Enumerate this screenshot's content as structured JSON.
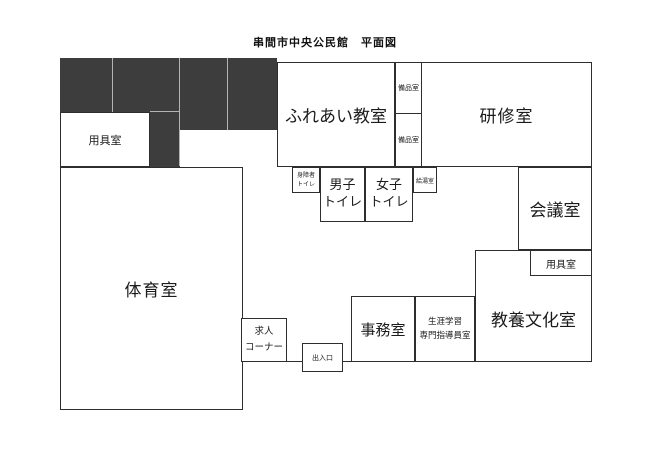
{
  "title": "串間市中央公民館　平面図",
  "rooms": {
    "equipment_upper_left": {
      "label": "用具室"
    },
    "gymnasium": {
      "label": "体育室"
    },
    "fureai_classroom": {
      "label": "ふれあい教室"
    },
    "supplies_upper": {
      "label": "備品室"
    },
    "supplies_lower": {
      "label": "備品室"
    },
    "training_room": {
      "label": "研修室"
    },
    "accessible_toilet": {
      "label": "身障者\nトイレ"
    },
    "mens_toilet": {
      "label": "男子\nトイレ"
    },
    "womens_toilet": {
      "label": "女子\nトイレ"
    },
    "hot_water_room": {
      "label": "給湯室"
    },
    "conference_room": {
      "label": "会議室"
    },
    "equipment_right": {
      "label": "用具室"
    },
    "culture_room": {
      "label": "教養文化室"
    },
    "office": {
      "label": "事務室"
    },
    "lifelong_learning_office": {
      "label": "生涯学習\n専門指導員室"
    },
    "job_corner": {
      "label": "求人\nコーナー"
    },
    "entrance": {
      "label": "出入口"
    }
  },
  "colors": {
    "wall": "#2e2e2e",
    "dark_block": "#3d3d3d",
    "divider": "#b4b4b4",
    "background": "#ffffff",
    "text": "#1b1b1b"
  }
}
